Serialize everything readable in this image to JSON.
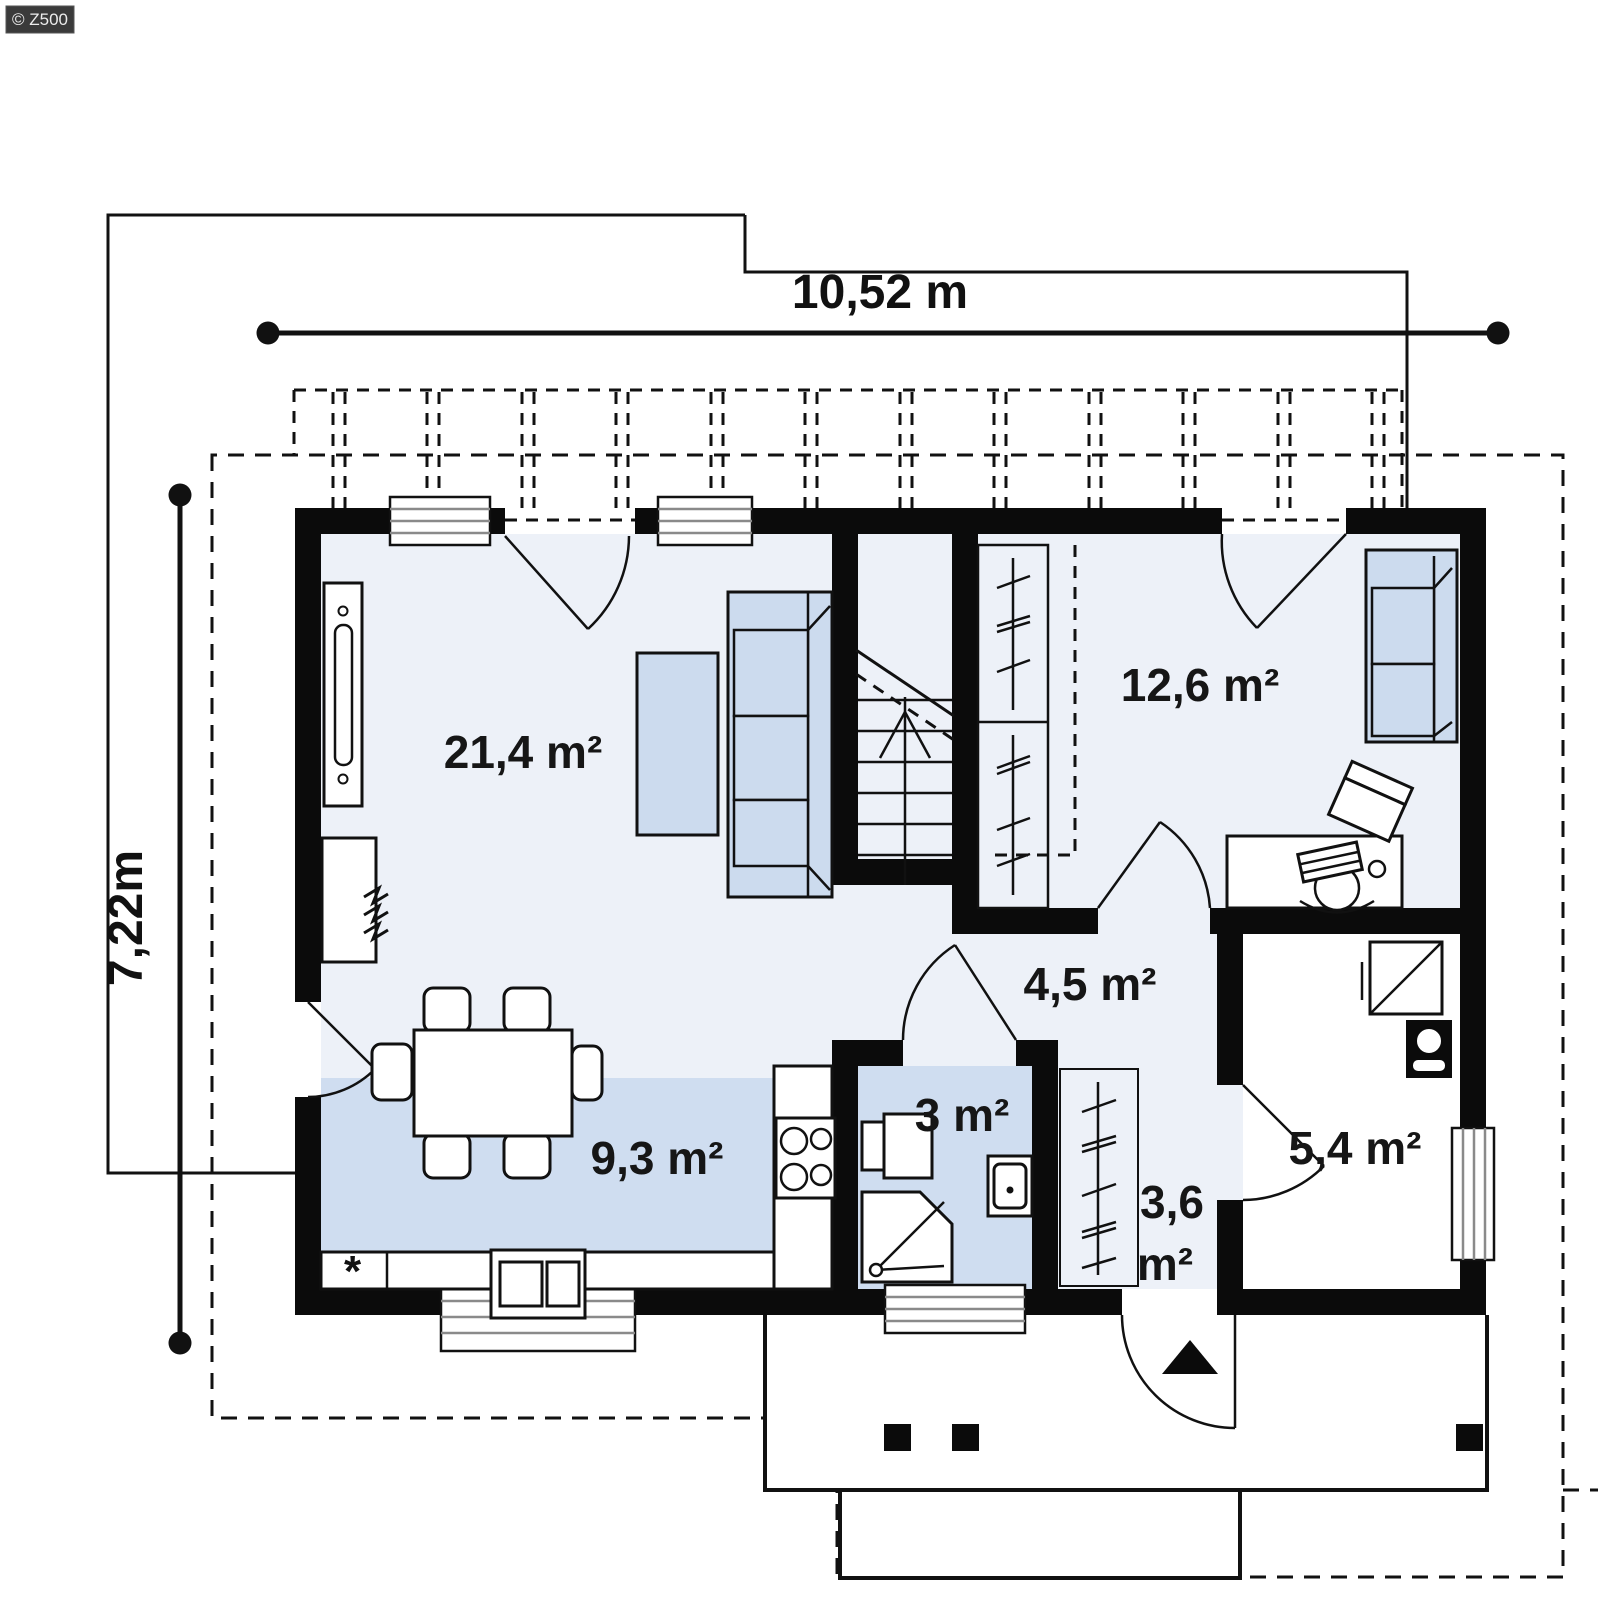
{
  "watermark": "© Z500",
  "dimensions": {
    "width": "10,52 m",
    "height": "7,22m"
  },
  "rooms": {
    "living": {
      "area": "21,4 m²"
    },
    "bedroom": {
      "area": "12,6 m²"
    },
    "hall": {
      "area": "4,5 m²"
    },
    "bathroom": {
      "area": "3 m²"
    },
    "kitchen": {
      "area": "9,3 m²"
    },
    "wardrobe": {
      "area_line1": "3,6",
      "area_line2": "m²"
    },
    "utility": {
      "area": "5,4 m²"
    }
  },
  "symbols": {
    "fridge_mark": "*"
  },
  "colors": {
    "wall": "#0b0b0b",
    "floor_light": "#edf1f8",
    "floor_accent": "#cfddf0",
    "furniture_blue": "#ccdbee",
    "watermark_bg": "#3a3a3a"
  }
}
